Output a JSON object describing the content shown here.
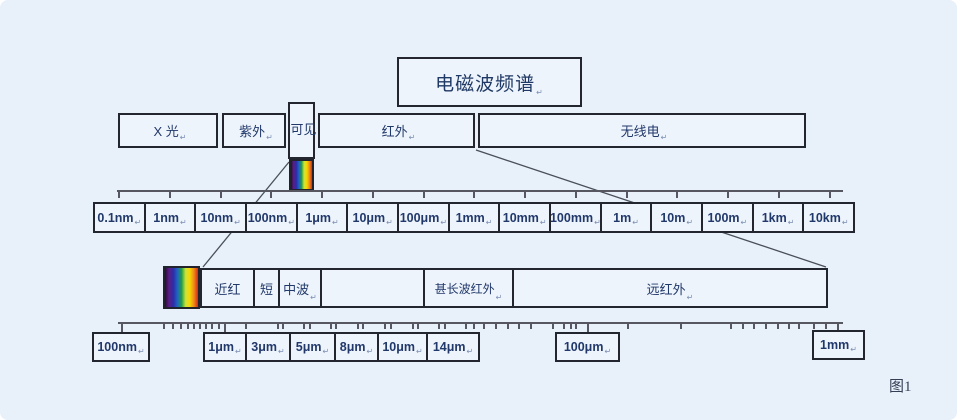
{
  "figure": {
    "caption": "图1"
  },
  "title": {
    "text": "电磁波频谱",
    "mark": true
  },
  "symbols": {
    "line_break_mark": "↵"
  },
  "colors": {
    "background": "#e8f0f9",
    "box_fill": "#eef4fb",
    "box_border": "#23262e",
    "text": "#21386b",
    "ruler": "#575762",
    "mark": "#7b8fb5"
  },
  "spectrum_colors": [
    "#2f0b3a",
    "#5a1f86",
    "#2c2ca8",
    "#1f63c4",
    "#1d9e45",
    "#cfe23a",
    "#f5d800",
    "#ef8b1a",
    "#d8261a"
  ],
  "strips": {
    "visible_small": {
      "x": 289,
      "y": 159,
      "w": 25,
      "h": 32
    },
    "visible_expanded": {
      "x": 163,
      "y": 266,
      "w": 37,
      "h": 43
    }
  },
  "top_band": {
    "boxes": [
      {
        "name": "x-ray",
        "label": "X 光",
        "mark": true,
        "x": 118,
        "y": 113,
        "w": 100,
        "h": 35
      },
      {
        "name": "ultraviolet",
        "label": "紫外",
        "mark": true,
        "x": 222,
        "y": 113,
        "w": 64,
        "h": 35
      },
      {
        "name": "visible",
        "label": "可见",
        "mark": false,
        "x": 288,
        "y": 102,
        "w": 27,
        "h": 57,
        "vertical": true
      },
      {
        "name": "infrared",
        "label": "红外",
        "mark": true,
        "x": 318,
        "y": 113,
        "w": 157,
        "h": 35
      },
      {
        "name": "radio",
        "label": "无线电",
        "mark": true,
        "x": 478,
        "y": 113,
        "w": 328,
        "h": 35
      }
    ]
  },
  "ruler1": {
    "y": 190,
    "x1": 117,
    "x2": 843,
    "tick_len": 8,
    "ticks": [
      118,
      169,
      220,
      270,
      321,
      372,
      423,
      473,
      524,
      575,
      626,
      676,
      727,
      778,
      829
    ],
    "labels_box": {
      "x": 93,
      "y": 202,
      "w": 762,
      "h": 31
    },
    "labels": [
      "0.1nm",
      "1nm",
      "10nm",
      "100nm",
      "1μm",
      "10μm",
      "100μm",
      "1mm",
      "10mm",
      "100mm",
      "1m",
      "10m",
      "100m",
      "1km",
      "10km"
    ]
  },
  "infrared_band": {
    "x": 200,
    "y": 268,
    "w": 628,
    "h": 40,
    "cells": [
      {
        "name": "near-infrared",
        "label": "近红",
        "mark": false,
        "w": 53
      },
      {
        "name": "short-wave-infrared",
        "label": "短",
        "mark": false,
        "w": 25
      },
      {
        "name": "mid-wave-infrared",
        "label": "中波",
        "mark": true,
        "w": 42
      },
      {
        "name": "unlabeled-band",
        "label": "",
        "mark": false,
        "w": 103
      },
      {
        "name": "very-long-wave-infrared",
        "label": "甚长波红外",
        "mark": true,
        "w": 89,
        "font": 12
      },
      {
        "name": "far-infrared",
        "label": "远红外",
        "mark": true
      }
    ]
  },
  "ruler2": {
    "y": 322,
    "x1": 118,
    "x2": 843,
    "tick_len": 7,
    "long_tick_len": 11,
    "ticks": [
      163,
      172,
      180,
      187,
      193,
      199,
      205,
      211,
      218,
      245,
      277,
      282,
      303,
      309,
      330,
      335,
      357,
      362,
      384,
      390,
      412,
      417,
      438,
      444,
      465,
      473,
      483,
      495,
      507,
      518,
      530,
      552,
      563,
      570,
      575,
      627,
      680,
      730,
      742,
      753,
      765,
      777,
      788,
      798,
      813,
      825
    ],
    "long_ticks": [
      121,
      224,
      587,
      837
    ],
    "boxes": [
      {
        "x": 92,
        "y": 332,
        "w": 58,
        "h": 30,
        "cells": [
          {
            "label": "100nm",
            "mark": true
          }
        ]
      },
      {
        "x": 203,
        "y": 332,
        "w": 277,
        "h": 30,
        "cells": [
          {
            "label": "1μm",
            "mark": true,
            "w": 42
          },
          {
            "label": "3μm",
            "mark": true,
            "w": 44
          },
          {
            "label": "5μm",
            "mark": true,
            "w": 45
          },
          {
            "label": "8μm",
            "mark": true,
            "w": 43
          },
          {
            "label": "10μm",
            "mark": true,
            "w": 49
          },
          {
            "label": "14μm",
            "mark": true
          }
        ]
      },
      {
        "x": 555,
        "y": 332,
        "w": 65,
        "h": 30,
        "cells": [
          {
            "label": "100μm",
            "mark": true
          }
        ]
      },
      {
        "x": 812,
        "y": 330,
        "w": 53,
        "h": 30,
        "cells": [
          {
            "label": "1mm",
            "mark": true
          }
        ]
      }
    ]
  }
}
